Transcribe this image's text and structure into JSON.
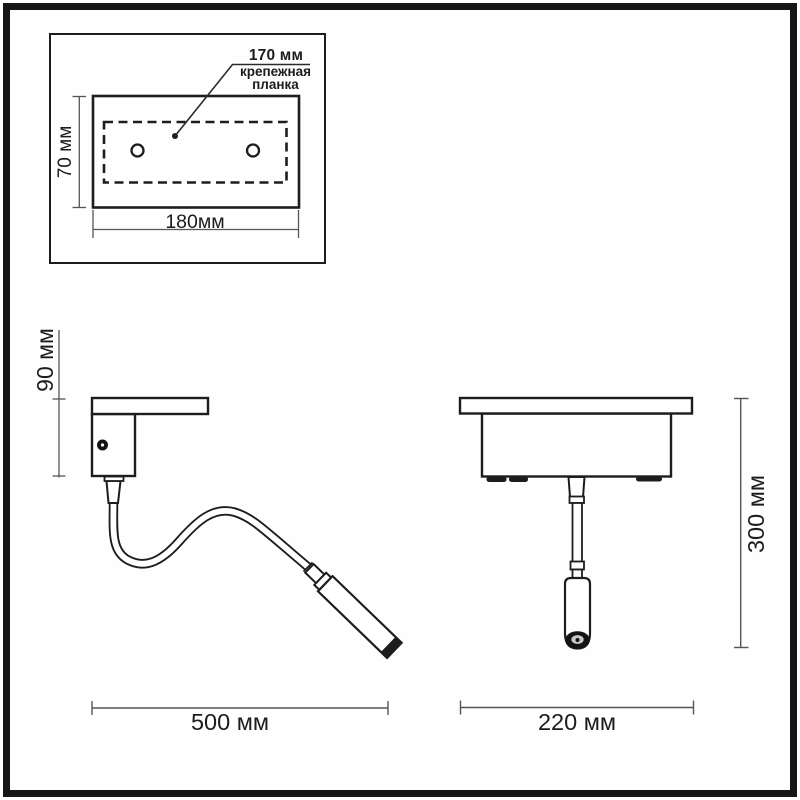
{
  "document": {
    "type": "lamp-dimension-drawing",
    "views": [
      "mounting-plate-top-view",
      "side-view",
      "front-view"
    ]
  },
  "colors": {
    "background": "#fefefe",
    "frame": "#161616",
    "outline": "#1d1d1d",
    "dimension_line": "#555555",
    "text": "#1c1c1c"
  },
  "mounting_plate_view": {
    "hole_spacing": "170 мм",
    "plate_label_line1": "крепежная",
    "plate_label_line2": "планка",
    "height": "70 мм",
    "width": "180мм"
  },
  "side_view": {
    "bracket_height": "90 мм",
    "reach": "500 мм"
  },
  "front_view": {
    "height": "300 мм",
    "width": "220 мм"
  }
}
